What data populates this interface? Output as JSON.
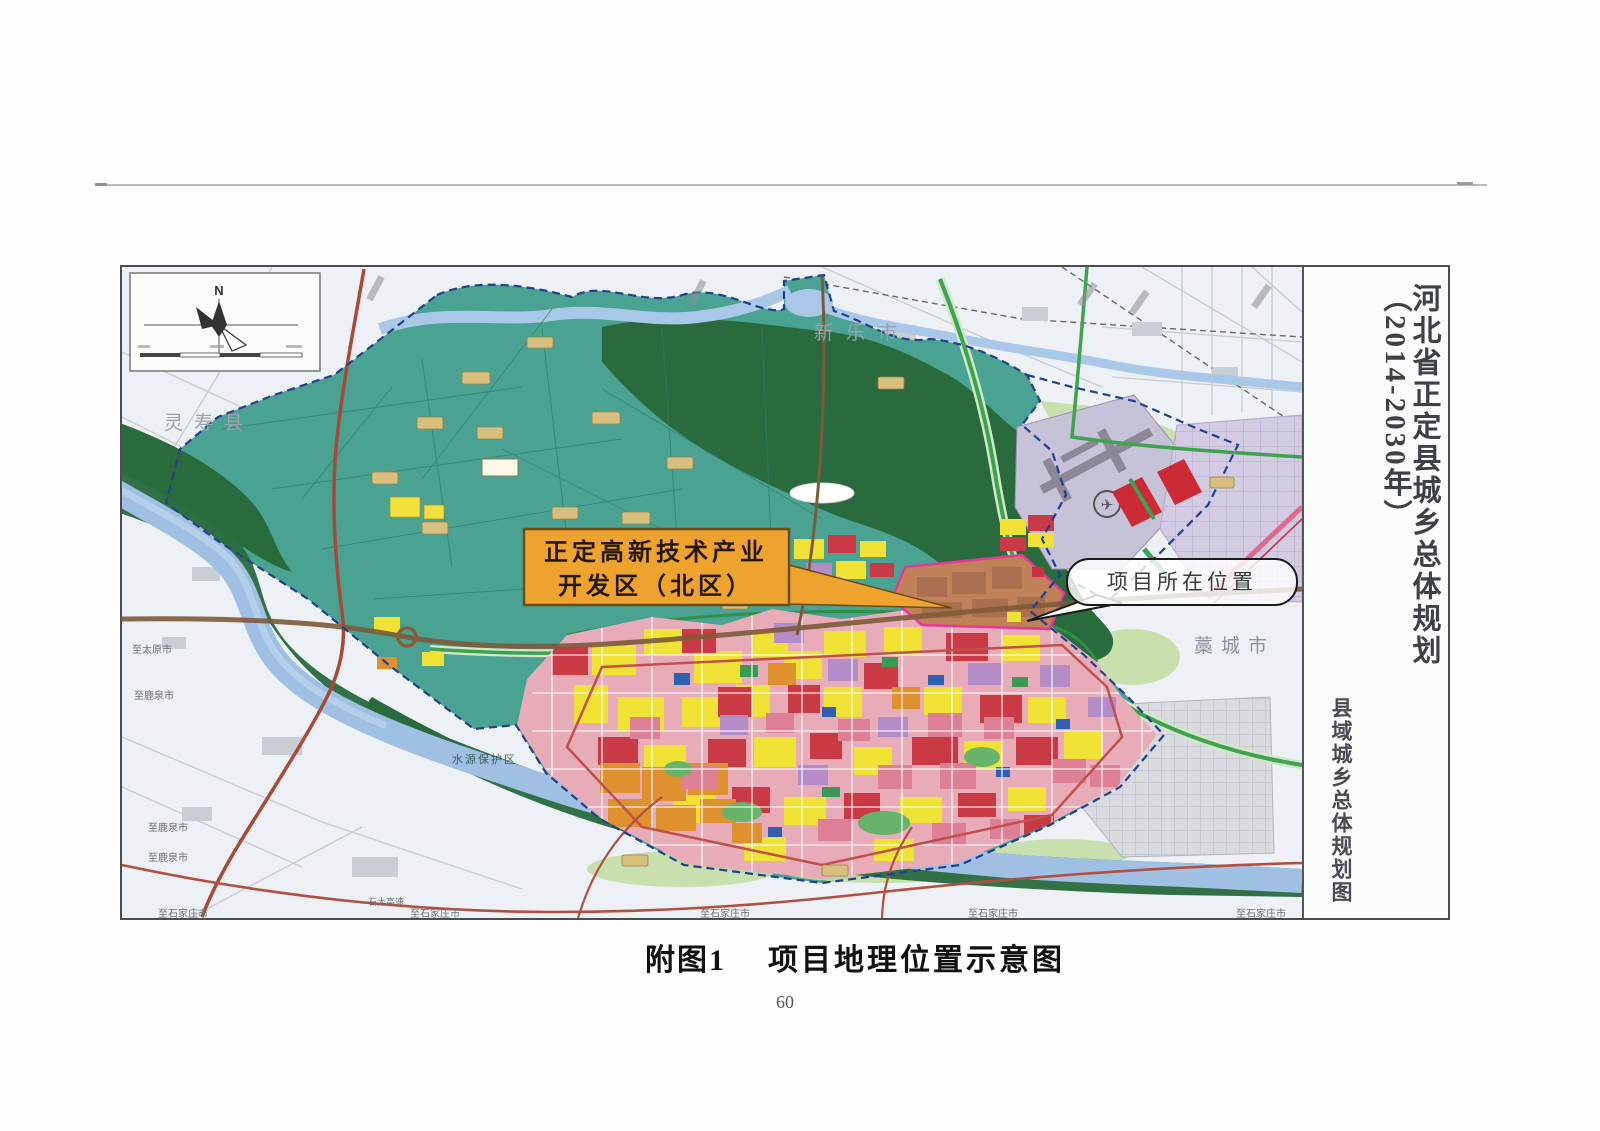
{
  "page": {
    "number": "60"
  },
  "caption": {
    "label": "附图1",
    "title": "项目地理位置示意图"
  },
  "panel": {
    "main_title": "河北省正定县城乡总体规划（2014-2030年）",
    "sub_title": "县域城乡总体规划图"
  },
  "map": {
    "compass_north": "N",
    "labels": {
      "lingshou": "灵寿县",
      "xinle": "新乐市",
      "gaocheng": "藁城市",
      "water_protect": "水源保护区"
    },
    "callout_devzone": {
      "line1": "正定高新技术产业",
      "line2": "开发区（北区）"
    },
    "callout_project": "项目所在位置",
    "roads": {
      "to_taiyuan": "至太原市",
      "to_luquan": "至鹿泉市",
      "shitai_expwy": "石太高速",
      "to_shijiazhuang": "至石家庄市"
    },
    "airport_symbol": "✈"
  },
  "colors": {
    "county_teal": "#4aa392",
    "forest_green": "#2a6b3e",
    "river_blue": "#a6c3e3",
    "callout_orange": "#efa32f",
    "boundary_blue": "#23408f"
  }
}
